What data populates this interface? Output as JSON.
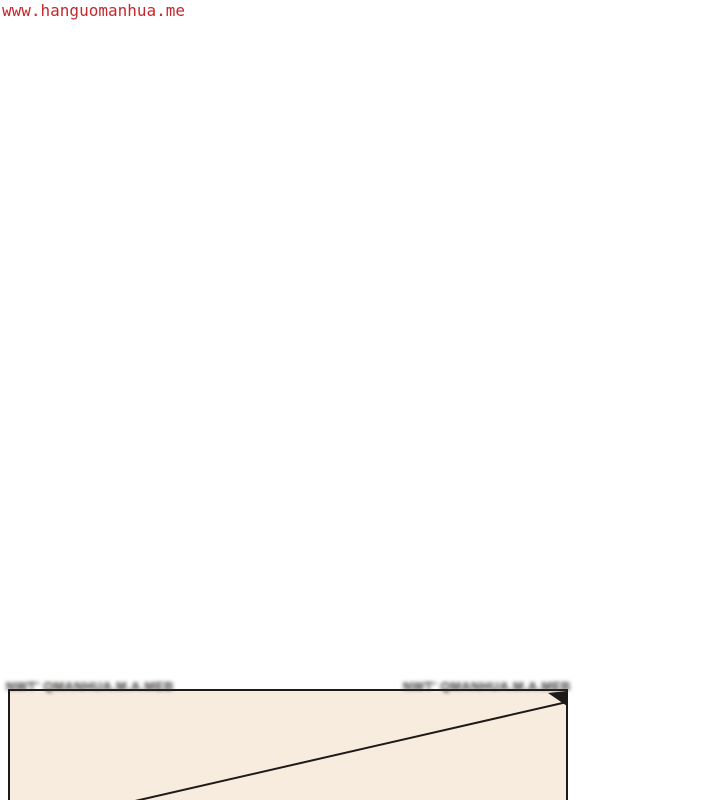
{
  "theme": {
    "bg": "#ffffff",
    "watermark-red": "#c5272d",
    "panel-fill": "#f8ecdf",
    "panel-line": "#1d1a17",
    "blur-text": "#332f2c"
  },
  "page": {
    "site_watermark": "www.hanguomanhua.me"
  },
  "comic_panel": {
    "blurred_caption_left": "NWT' QMANHUA.M.A.MEB",
    "blurred_caption_right": "NWT' QMANHUA.M.A.MEB"
  }
}
